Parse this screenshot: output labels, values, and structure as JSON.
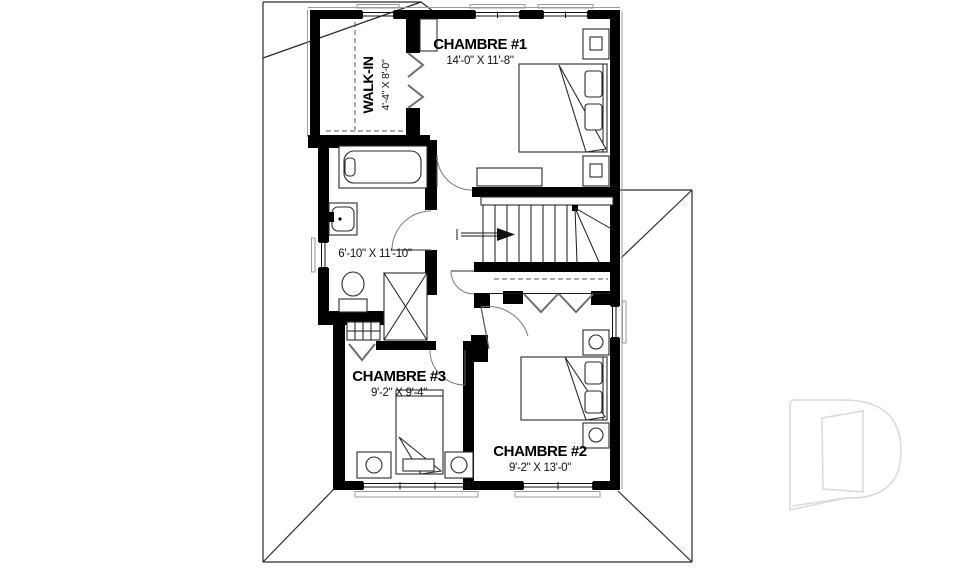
{
  "plan": {
    "type": "floor-plan-second-storey",
    "rooms": {
      "chambre1": {
        "label": "CHAMBRE #1",
        "dims": "14'-0\" X 11'-8\""
      },
      "chambre2": {
        "label": "CHAMBRE #2",
        "dims": "9'-2\" X 13'-0\""
      },
      "chambre3": {
        "label": "CHAMBRE #3",
        "dims": "9'-2\" X 9'-4\""
      },
      "walkin": {
        "label": "WALK-IN",
        "dims": "4'-4\" X 8'-0\""
      },
      "bathroom": {
        "dims": "6'-10\" X 11'-10\""
      }
    },
    "colors": {
      "wall": "#000000",
      "line": "#2a2a2a",
      "sill": "#9a9a9a",
      "logo": "#d9d9d9",
      "background": "#ffffff"
    },
    "icons": {
      "stair_direction": "up-arrow",
      "brand": "d-logo-watermark"
    }
  }
}
